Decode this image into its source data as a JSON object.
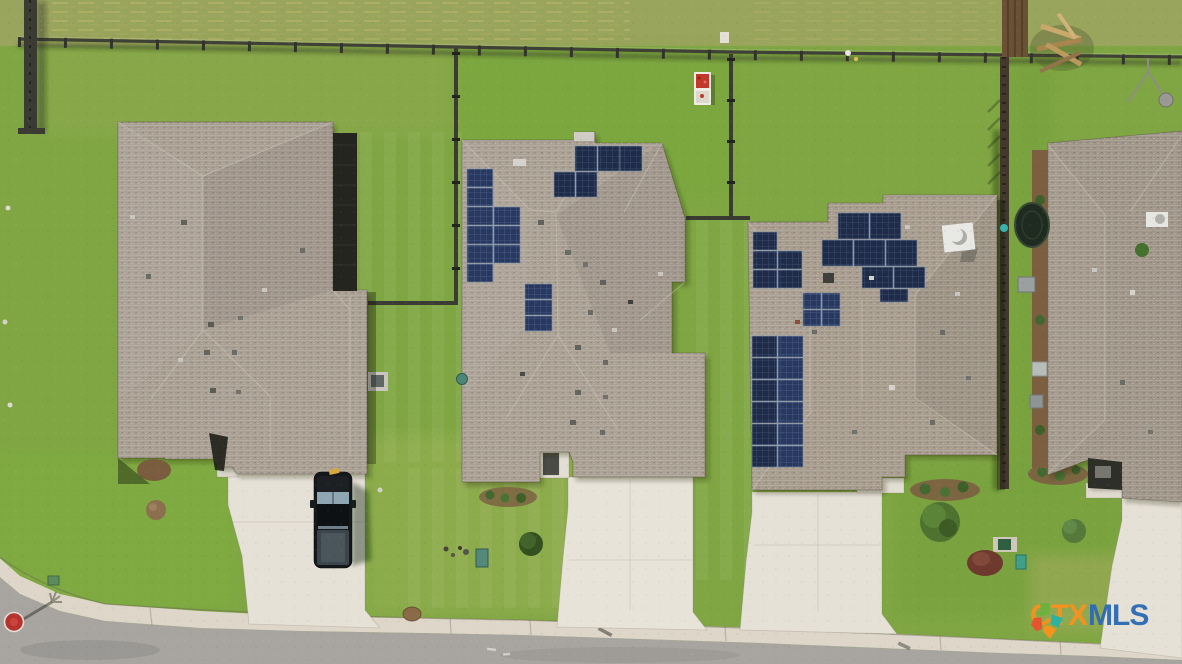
{
  "watermark": {
    "brand_prefix": "CTX",
    "brand_suffix": "MLS",
    "logo": "ctx-mls-texas-logo"
  },
  "palette": {
    "grass": "#7fa643",
    "grass-dry": "#a9a862",
    "roof": "#a99f93",
    "roof-shadow": "#23251e",
    "solar-panel": "#1f2a42",
    "driveway": "#e6e1d6",
    "sidewalk": "#ddd6c9",
    "road": "#a8a5a1",
    "fence": "#3b3c33",
    "truck-body": "#15181a",
    "stop-sign": "#b5332c",
    "wm-orange": "#f6921e",
    "wm-blue": "#2d6cb4",
    "logo-green": "#6cb33f",
    "logo-teal": "#2bb3a3",
    "logo-orange": "#f7941d",
    "logo-red": "#e8542e"
  },
  "scene": {
    "view": "aerial-residential-street",
    "houses": [
      {
        "id": "house-left",
        "solar_panels": 0
      },
      {
        "id": "house-middle",
        "solar_panels": 17
      },
      {
        "id": "house-right",
        "solar_panels": 26
      },
      {
        "id": "house-far-right",
        "solar_panels": 0
      }
    ],
    "vehicles": [
      {
        "id": "pickup-truck",
        "color": "black",
        "location": "left-driveway"
      }
    ]
  }
}
